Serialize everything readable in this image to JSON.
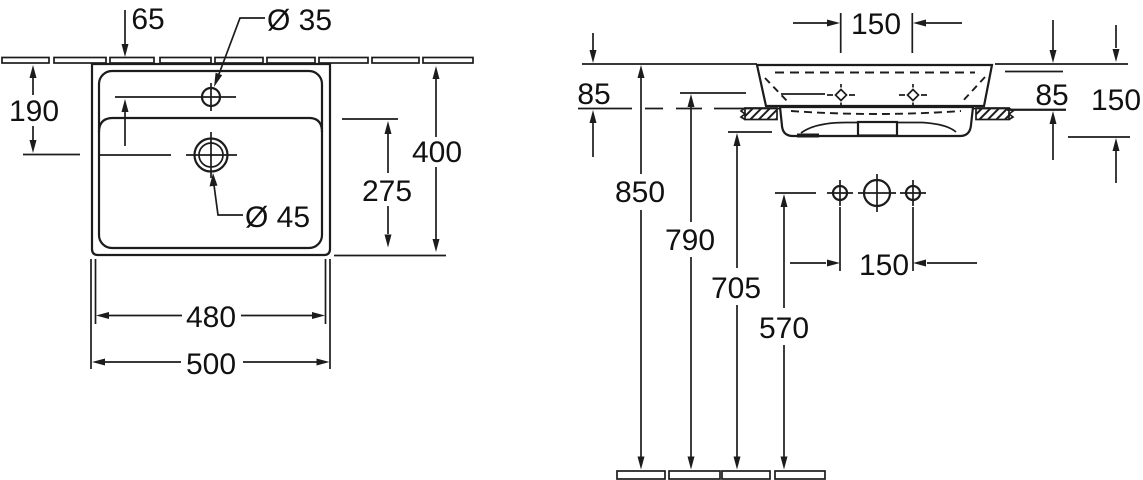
{
  "document": {
    "type": "technical-drawing",
    "subject": "Wall-mounted washbasin installation drawing, dimensions in mm"
  },
  "plan_view": {
    "labels": {
      "tap_offset": "65",
      "tap_hole_dia": "Ø 35",
      "drain_from_wall": "190",
      "overall_depth": "400",
      "drain_to_front": "275",
      "drain_dia": "Ø 45",
      "inner_width": "480",
      "overall_width": "500"
    }
  },
  "side_view": {
    "labels": {
      "tap_hole_spacing": "150",
      "rim_to_ledge_left": "85",
      "rim_to_ledge_right": "85",
      "basin_depth_right": "150",
      "rim_height": "850",
      "fixing_hole_height": "790",
      "apron_bottom_height": "705",
      "outlet_height": "570",
      "outlet_spacing": "150"
    }
  }
}
